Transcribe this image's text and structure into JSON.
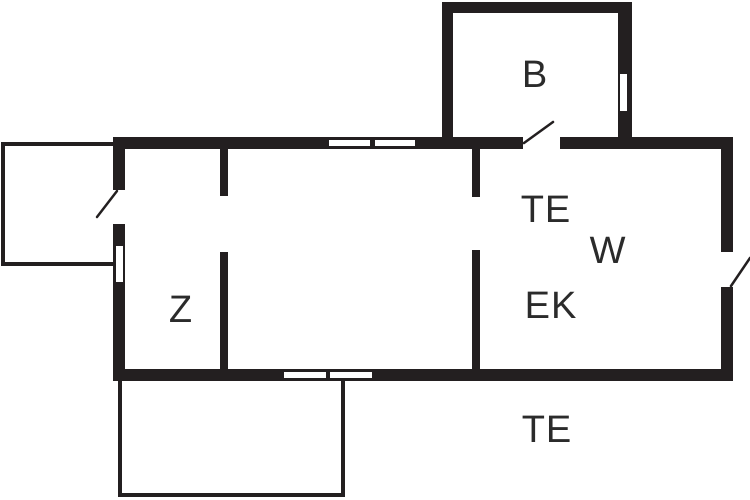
{
  "floor_plan": {
    "title": "floor-plan",
    "rooms": {
      "b_room": {
        "label": "B"
      },
      "te_upper": {
        "label": "TE"
      },
      "w_room": {
        "label": "W"
      },
      "ek_room": {
        "label": "EK"
      },
      "z_room": {
        "label": "Z"
      },
      "te_terrace": {
        "label": "TE"
      }
    },
    "colors": {
      "wall": "#231f20",
      "background": "#ffffff",
      "label": "#2b2b2b"
    }
  }
}
